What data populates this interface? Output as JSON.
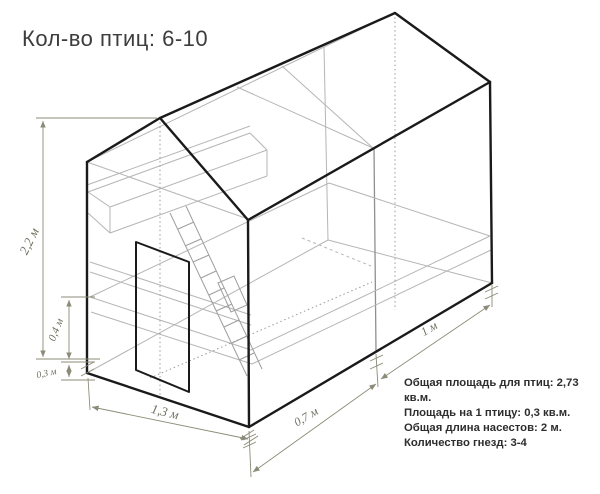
{
  "title": "Кол-во птиц: 6-10",
  "dimensions": {
    "height_total": "2,2 м",
    "height_platform": "0,4 м",
    "height_base": "0,3 м",
    "width_front": "1,3 м",
    "depth_front": "0,7 м",
    "depth_back": "1 м"
  },
  "info": {
    "lines": [
      "Общая площадь для птиц: 2,73 кв.м.",
      "Площадь на 1 птицу: 0,3 кв.м.",
      "Общая длина насестов: 2 м.",
      "Количество гнезд: 3-4"
    ]
  },
  "colors": {
    "outline": "#1a1a1a",
    "hidden_lines": "#b5b5b5",
    "dimension_lines": "#8b8b78",
    "text": "#2d2d2d"
  }
}
